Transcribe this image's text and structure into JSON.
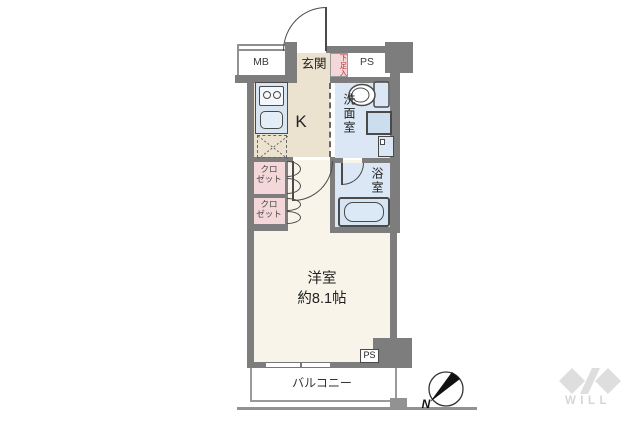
{
  "plan": {
    "mb": "MB",
    "entrance": "玄関",
    "shoe_cabinet": "下足入",
    "pipe_space_top": "PS",
    "kitchen": "K",
    "washroom": "洗面室",
    "bathroom": "浴室",
    "closet_upper_lines": [
      "クロ",
      "ゼット"
    ],
    "closet_lower_lines": [
      "クロ",
      "ゼット"
    ],
    "main_room_name": "洋室",
    "main_room_size": "約8.1帖",
    "pipe_space_bottom": "PS",
    "balcony": "バルコニー"
  },
  "compass": {
    "north": "N"
  },
  "brand": {
    "logo_text": "WILL"
  },
  "colors": {
    "wall": "#7d7d7d",
    "entrance_kitchen_floor": "#ece2d0",
    "main_room_floor": "#f8f4e9",
    "wet_area_floor": "#dbe7f4",
    "closet_fill": "#f4d7d9",
    "shoe_label_red": "#c0333d",
    "logo_gray": "#dedede"
  }
}
